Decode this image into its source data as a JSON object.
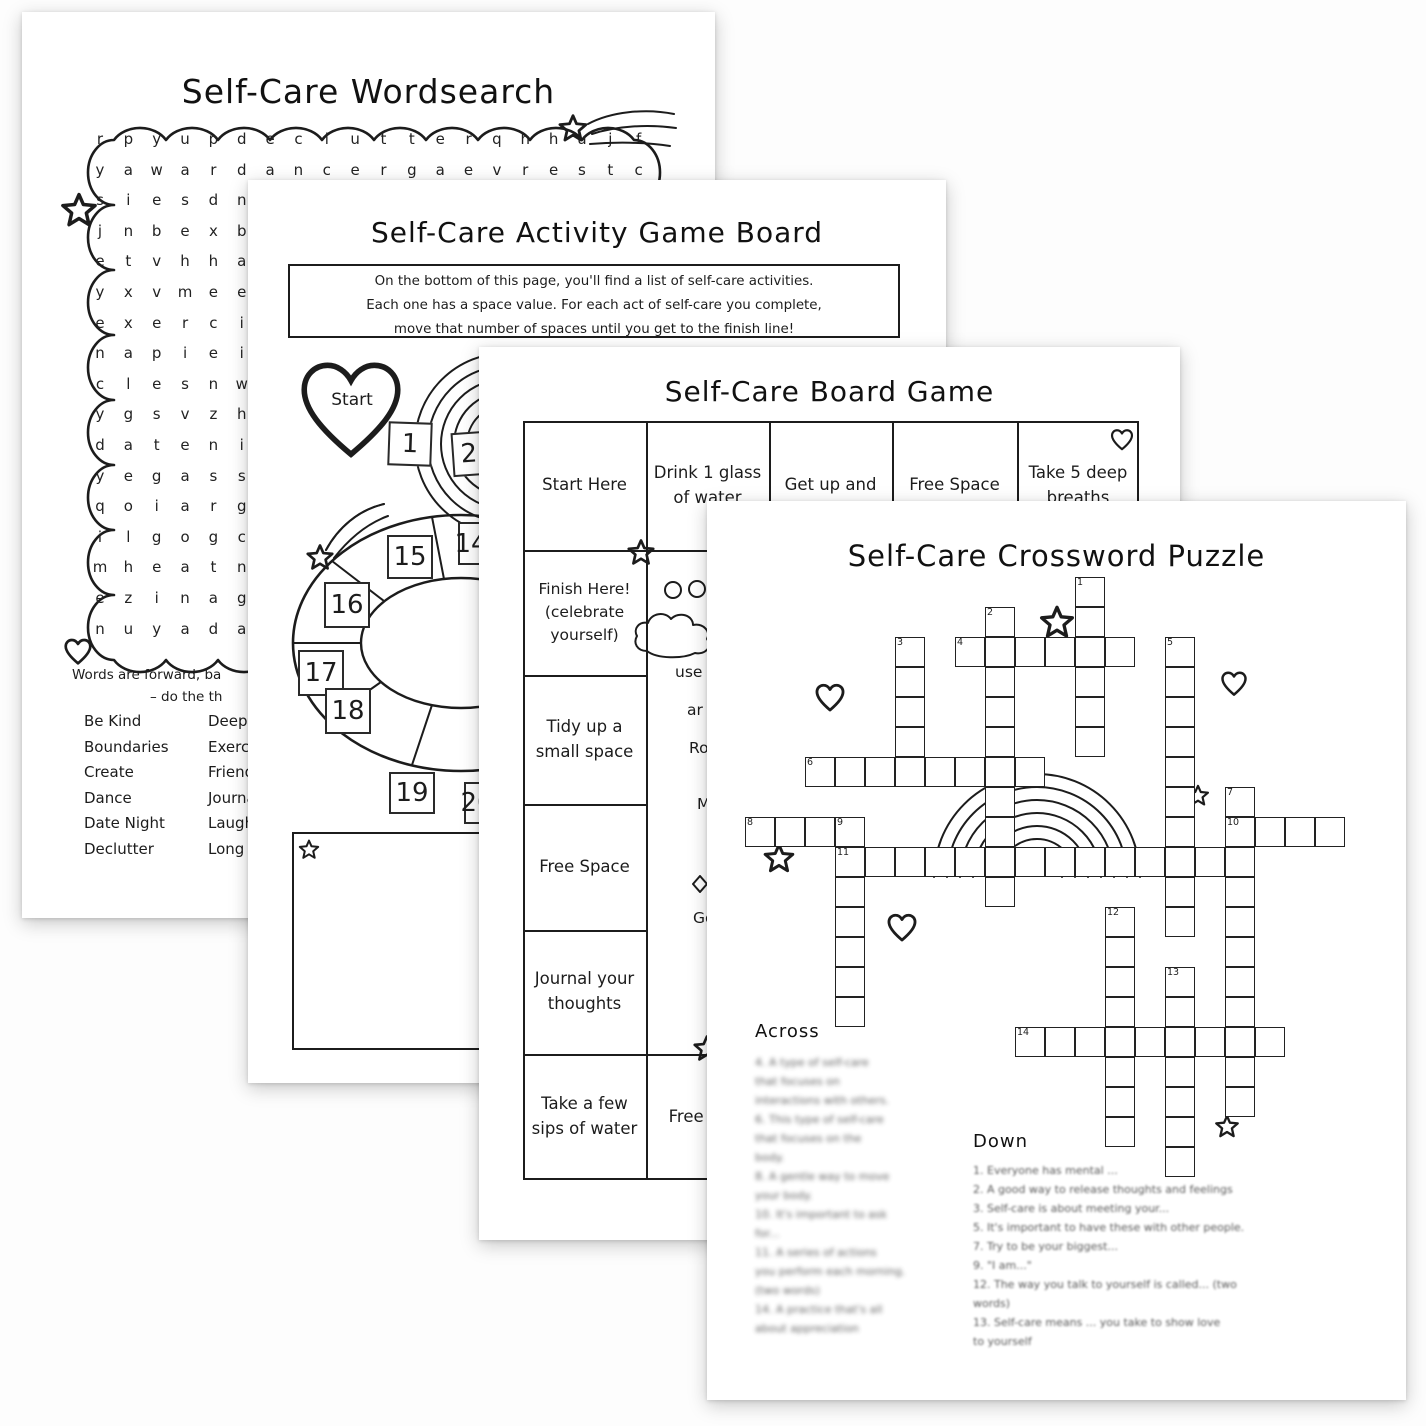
{
  "pages": {
    "wordsearch": {
      "title": "Self-Care Wordsearch",
      "letter_rows": [
        "r p y u p d e c l u t t e r q h h u j f",
        "y a w a r d a n c e r g a e v r e s t c",
        "s i e s d n",
        "j n b e x b",
        "e t v h h a",
        "y x v m e e",
        "e x e r c i",
        "n a p i e i",
        "c l e s n w",
        "y g s v z h",
        "d a t e n i",
        "y e g a s s",
        "q o i a r g",
        "i l g o g c",
        "m h e a t n",
        "e z i n a g",
        "n u y a d a"
      ],
      "note_line1": "Words are forward, ba",
      "note_line2": "– do the th",
      "word_list_col1": [
        "Be Kind",
        "Boundaries",
        "Create",
        "Dance",
        "Date Night",
        "Declutter"
      ],
      "word_list_col2": [
        "Deep B",
        "Exercis",
        "Friends",
        "Journal",
        "Laugh",
        "Long S"
      ]
    },
    "activity_board": {
      "title": "Self-Care Activity Game Board",
      "instructions": [
        "On the bottom of this page, you'll find a list of self-care activities.",
        "Each one has a space value. For each act of self-care you complete,",
        "move that number of spaces until you get to the finish line!"
      ],
      "start_label": "Start",
      "path_square_1": "1",
      "path_square_2": "2",
      "ring_squares": [
        {
          "label": "14",
          "x": 210,
          "y": 342,
          "w": 26,
          "h": 43
        },
        {
          "label": "15",
          "x": 139,
          "y": 355,
          "w": 46,
          "h": 44
        },
        {
          "label": "16",
          "x": 76,
          "y": 402,
          "w": 46,
          "h": 46
        },
        {
          "label": "17",
          "x": 50,
          "y": 470,
          "w": 46,
          "h": 46
        },
        {
          "label": "18",
          "x": 77,
          "y": 508,
          "w": 46,
          "h": 46
        },
        {
          "label": "19",
          "x": 141,
          "y": 592,
          "w": 46,
          "h": 42
        },
        {
          "label": "20",
          "x": 216,
          "y": 602,
          "w": 26,
          "h": 42
        }
      ]
    },
    "board_game": {
      "title": "Self-Care Board Game",
      "top_row": [
        "Start Here",
        "Drink 1 glass of water",
        "Get up and",
        "Free Space",
        "Take 5 deep breaths"
      ],
      "left_column": [
        "Finish Here! (celebrate yourself)",
        "Tidy up a small space",
        "Free Space",
        "Journal your thoughts",
        "Take a few sips of water"
      ],
      "bottom_row_cell": "Free Spot",
      "fragments": {
        "f1": "use",
        "f2": "ar",
        "f3": "Ro",
        "f4": "M",
        "f5": "Go"
      }
    },
    "crossword": {
      "title": "Self-Care Crossword Puzzle",
      "across_heading": "Across",
      "down_heading": "Down",
      "across_clue_lines": [
        "4. A type of self-care",
        "that focuses on",
        "interactions with others.",
        "6. This type of self-care",
        "that focuses on the",
        "body.",
        "8. A gentle way to move",
        "your body.",
        "10. It's important to ask",
        "for...",
        "11. A series of actions",
        "you perform each morning.",
        "(two words)",
        "14. A practice that's all",
        "about appreciation"
      ],
      "down_clue_lines": [
        "1. Everyone has mental ...",
        "2. A good way to release thoughts and feelings",
        "3. Self-care is about meeting your...",
        "5. It's important to have these with other people.",
        "7. Try to be your biggest...",
        "9. \"I am...\"",
        "12. The way you talk to yourself is called... (two",
        "words)",
        "13. Self-care means ... you take to show love",
        "to yourself"
      ],
      "grid_words": [
        {
          "num": 1,
          "col": 11,
          "row": 0,
          "dir": "down",
          "len": 6
        },
        {
          "num": 2,
          "col": 8,
          "row": 1,
          "dir": "down",
          "len": 10
        },
        {
          "num": 3,
          "col": 5,
          "row": 2,
          "dir": "down",
          "len": 5
        },
        {
          "num": 4,
          "col": 7,
          "row": 2,
          "dir": "across",
          "len": 6
        },
        {
          "num": 5,
          "col": 14,
          "row": 2,
          "dir": "down",
          "len": 10
        },
        {
          "num": 6,
          "col": 2,
          "row": 6,
          "dir": "across",
          "len": 8
        },
        {
          "num": 7,
          "col": 16,
          "row": 7,
          "dir": "down",
          "len": 11
        },
        {
          "num": 8,
          "col": 0,
          "row": 8,
          "dir": "across",
          "len": 4
        },
        {
          "num": 9,
          "col": 3,
          "row": 8,
          "dir": "down",
          "len": 7
        },
        {
          "num": 10,
          "col": 16,
          "row": 8,
          "dir": "across",
          "len": 4
        },
        {
          "num": 11,
          "col": 3,
          "row": 9,
          "dir": "across",
          "len": 14
        },
        {
          "num": 12,
          "col": 12,
          "row": 11,
          "dir": "down",
          "len": 8
        },
        {
          "num": 13,
          "col": 14,
          "row": 13,
          "dir": "down",
          "len": 7
        },
        {
          "num": 14,
          "col": 9,
          "row": 15,
          "dir": "across",
          "len": 9
        }
      ]
    },
    "ink": "#1c1c1c"
  }
}
